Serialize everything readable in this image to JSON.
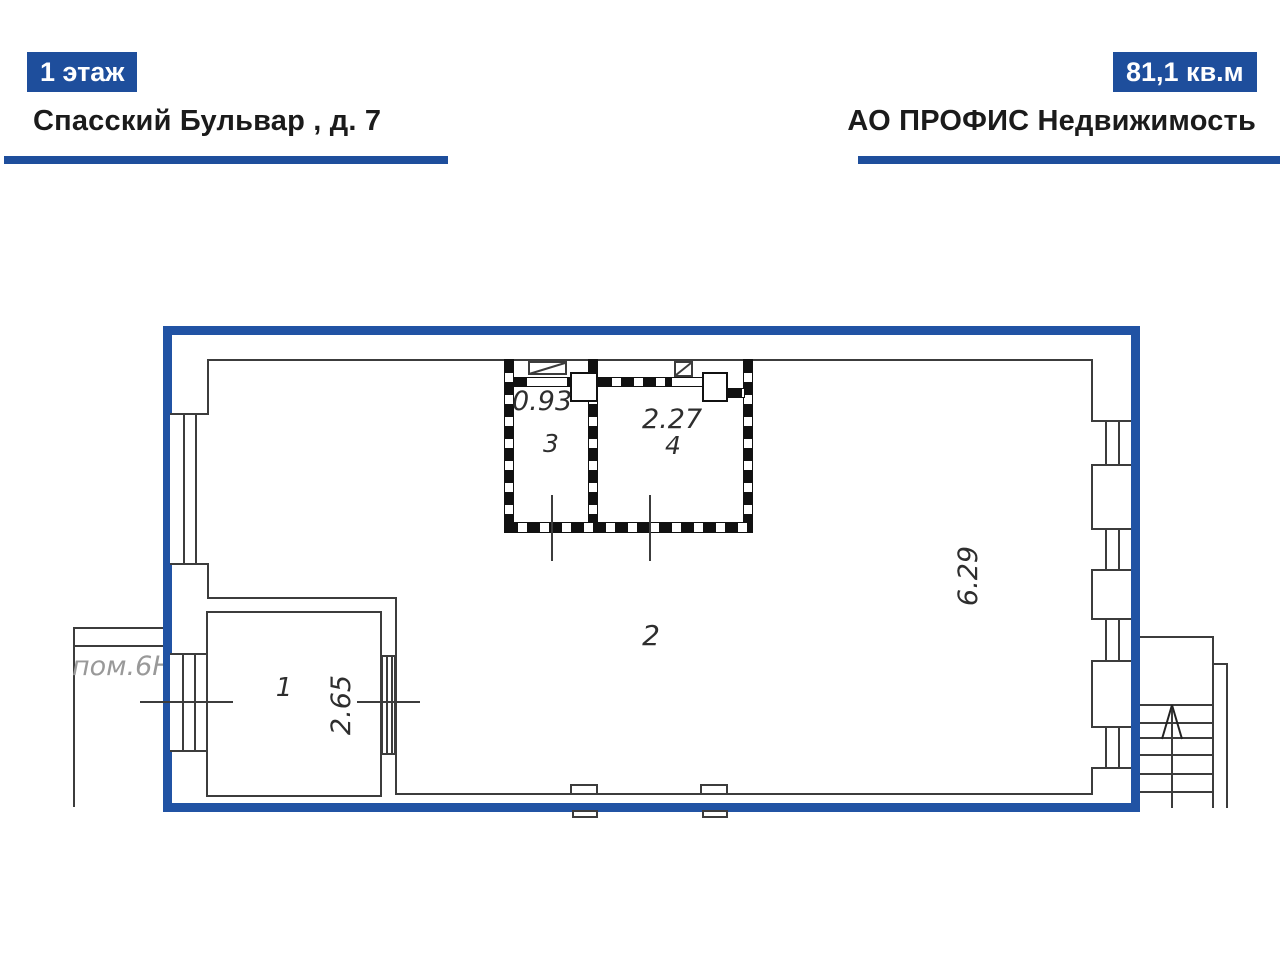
{
  "header": {
    "floor_badge": "1 этаж",
    "address": "Спасский Бульвар , д. 7",
    "area_badge": "81,1 кв.м",
    "company": "АО ПРОФИС Недвижимость"
  },
  "colors": {
    "accent_blue": "#1e4e9c",
    "plan_border_blue": "#2153a4",
    "line_dark": "#3c3c3c",
    "wall_black": "#111111",
    "neighbor_gray": "#999999"
  },
  "plan": {
    "neighbor_label": "пом.6Н",
    "room_numbers": [
      "1",
      "2",
      "3",
      "4"
    ],
    "dimensions": {
      "room1_width": "2.65",
      "room2_height": "6.29",
      "room3_width": "0.93",
      "room4_width": "2.27"
    },
    "icons": [
      "stairs-up-arrow-icon"
    ]
  }
}
